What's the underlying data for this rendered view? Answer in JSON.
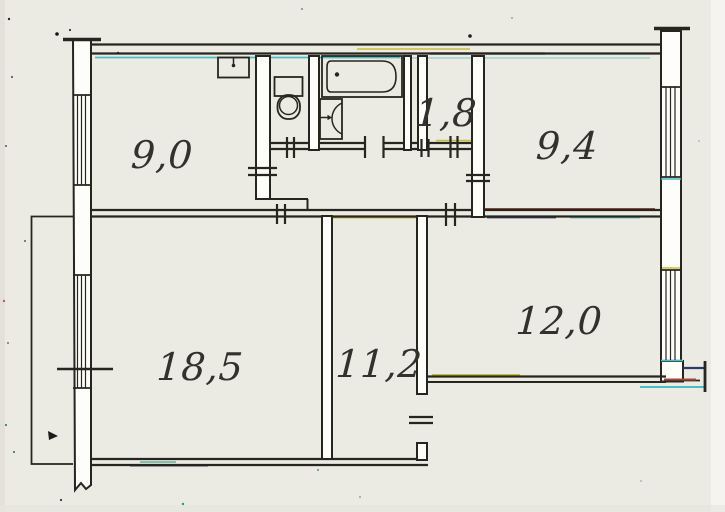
{
  "type": "scanned-apartment-floor-plan",
  "rooms": [
    {
      "id": "kitchen",
      "label": "9,0"
    },
    {
      "id": "storage",
      "label": "1,8"
    },
    {
      "id": "bedroom-1",
      "label": "9,4"
    },
    {
      "id": "living-room",
      "label": "18,5"
    },
    {
      "id": "room-11-2",
      "label": "11,2"
    },
    {
      "id": "room-12-0",
      "label": "12,0"
    }
  ],
  "fixtures": [
    {
      "id": "kitchen-sink-icon"
    },
    {
      "id": "toilet-icon"
    },
    {
      "id": "bathtub-icon"
    },
    {
      "id": "washbasin-icon"
    }
  ],
  "features": [
    "balcony",
    "windows-hatched",
    "door-tick-marks",
    "torn-wall-ends"
  ],
  "palette": {
    "paper": "#ecebe3",
    "ink": "#26261f",
    "cyan": "#49bcc6",
    "yellow": "#c9bd3e",
    "maroon": "#8a3326",
    "navy": "#2c3a6b",
    "teal": "#3aa58c",
    "red": "#a1473b"
  }
}
